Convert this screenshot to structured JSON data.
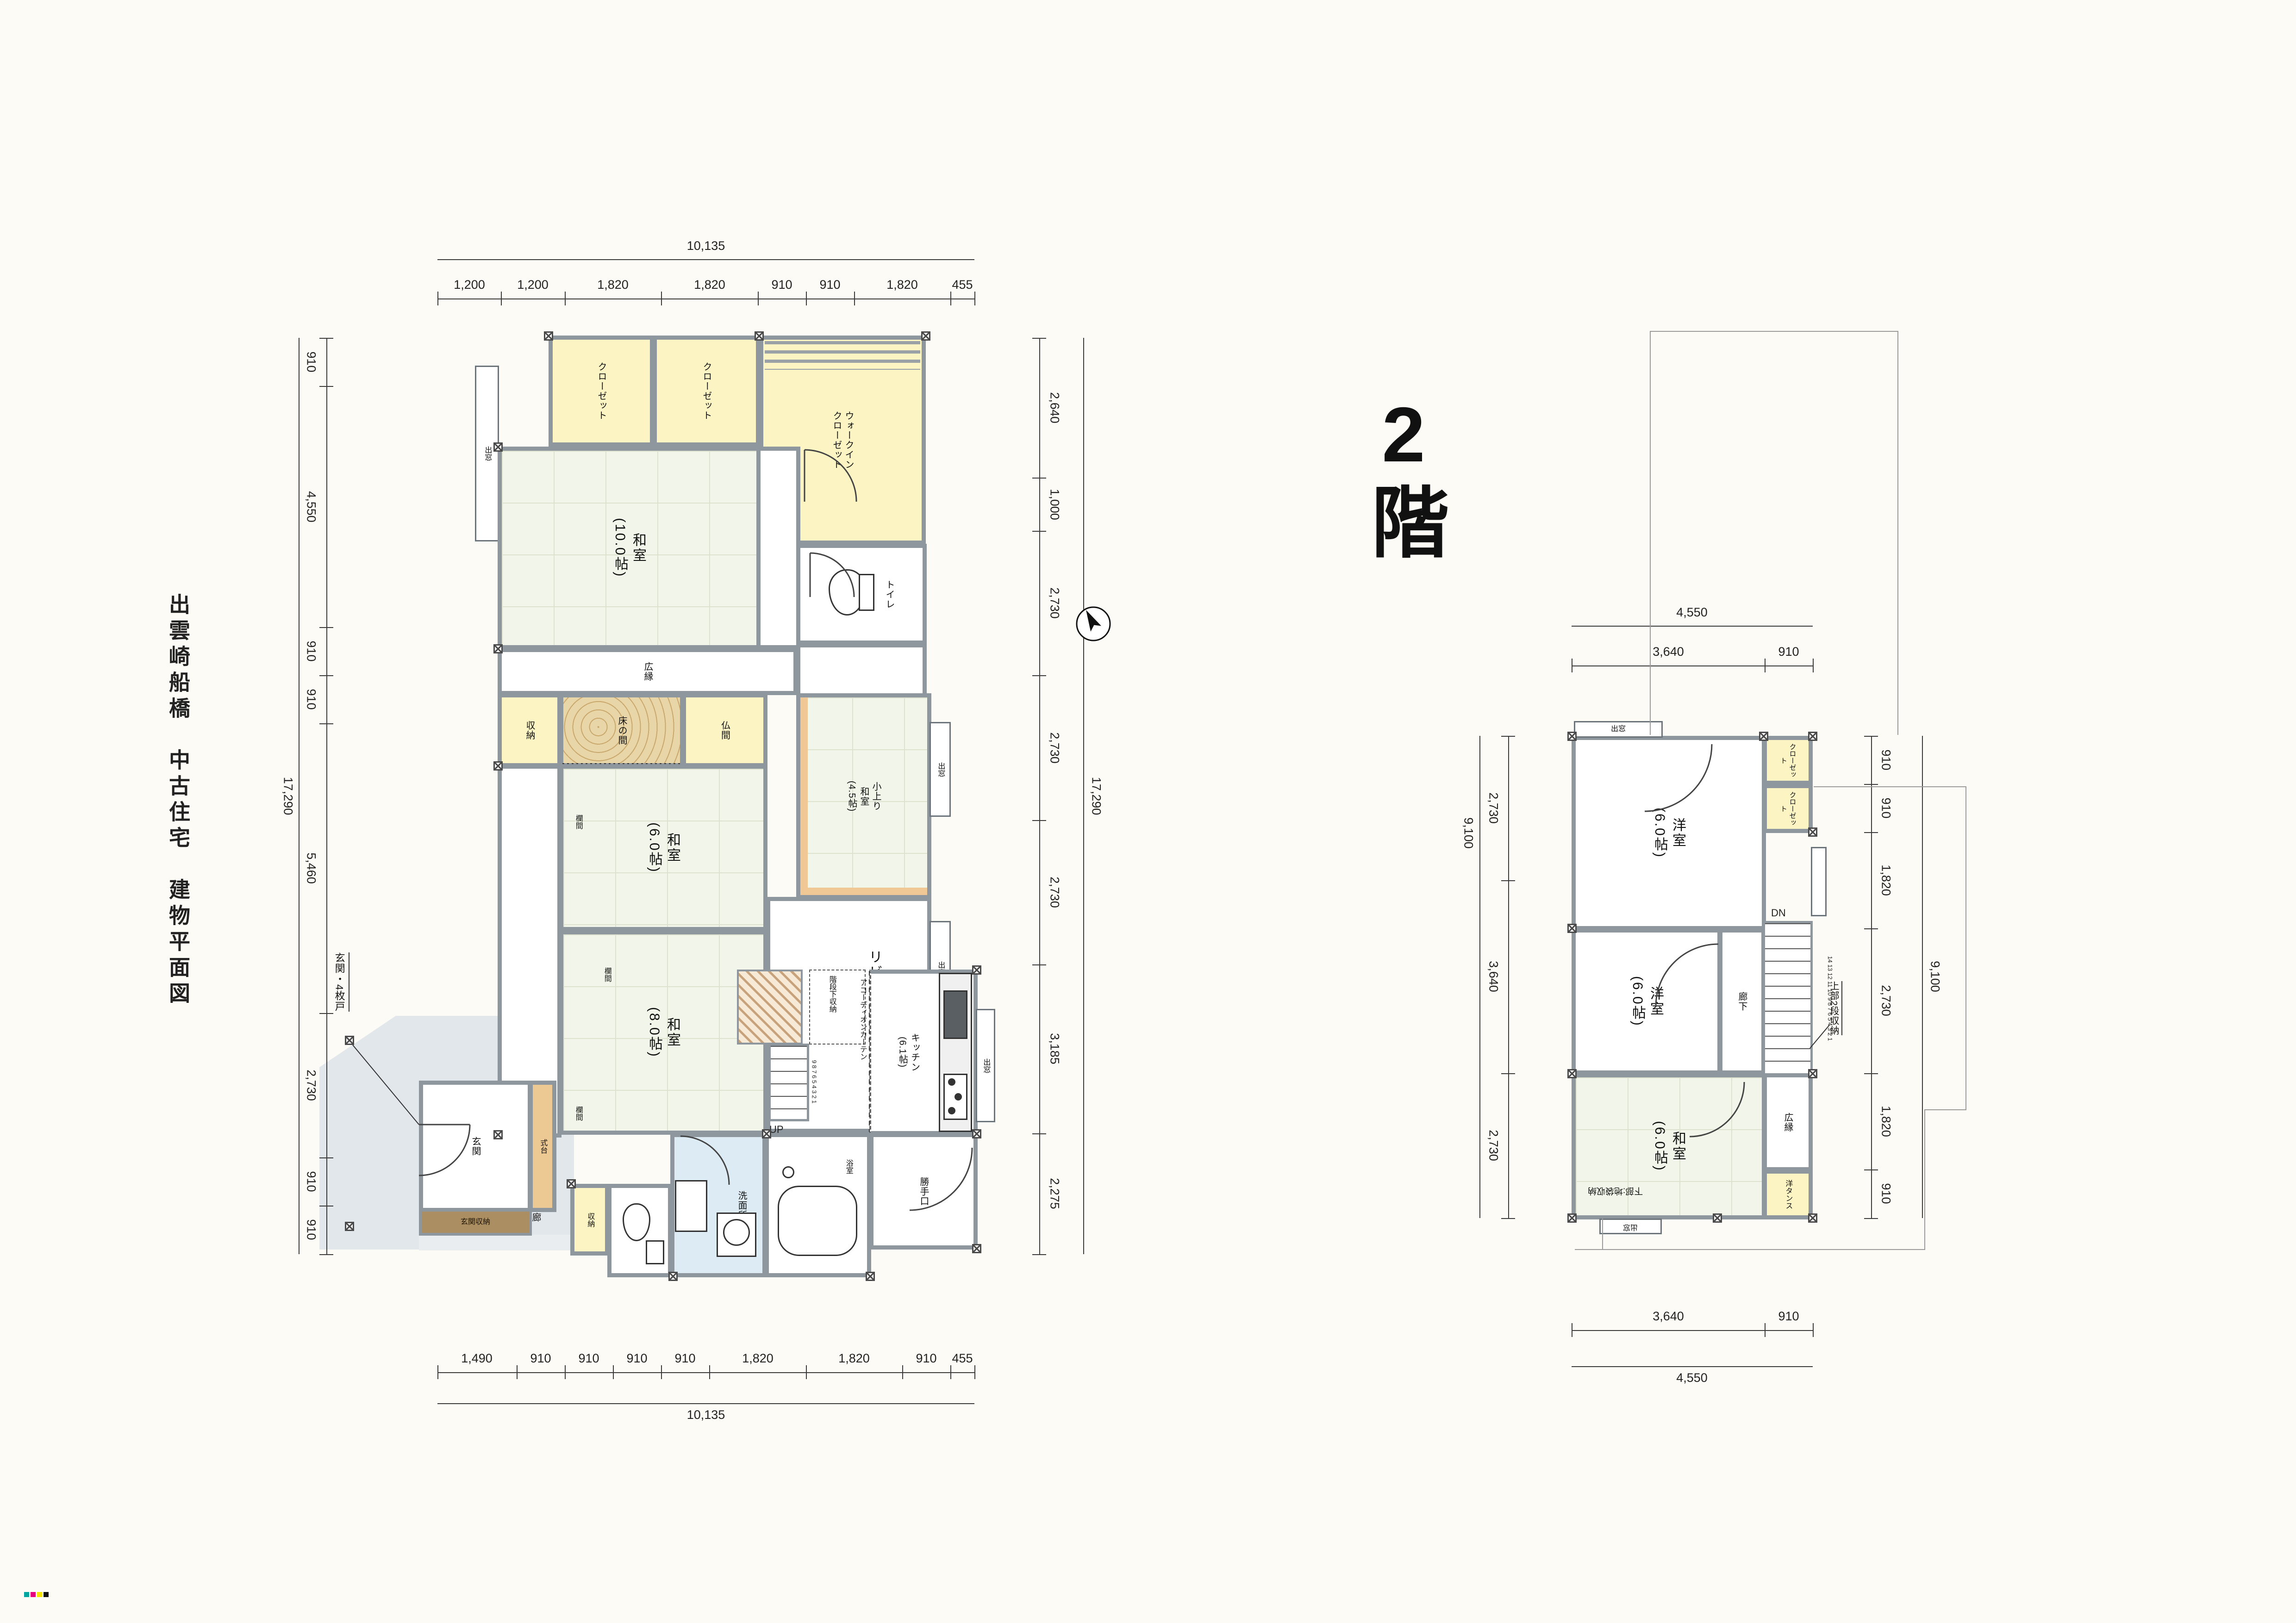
{
  "page": {
    "title": "出雲崎船橋　中古住宅　建物平面図"
  },
  "colors": {
    "wall": "#8e979e",
    "tatami": "#f2f5e9",
    "closet_yellow": "#fcf4c2",
    "tokonoma_wood": "#e8d6a9",
    "shikidai_wood": "#ecc892",
    "cabinet_brown": "#ab8f62",
    "wet_blue": "#ddecf4",
    "porch_gray": "#e2e7ec",
    "stair_hatch": "#c1946a"
  },
  "floor1": {
    "name": "1階",
    "dims": {
      "top_total": "10,135",
      "top_segments": [
        "1,200",
        "1,200",
        "1,820",
        "1,820",
        "910",
        "910",
        "1,820",
        "455"
      ],
      "bottom_segments": [
        "1,490",
        "910",
        "910",
        "910",
        "910",
        "1,820",
        "1,820",
        "910",
        "455"
      ],
      "bottom_total": "10,135",
      "left_segments": [
        "910",
        "4,550",
        "910",
        "910",
        "5,460",
        "2,730",
        "910",
        "910"
      ],
      "left_total": "17,290",
      "right_segments": [
        "2,640",
        "1,000",
        "2,730",
        "2,730",
        "2,730",
        "3,185",
        "2,275"
      ],
      "right_total": "17,290"
    },
    "rooms": {
      "closet": "クローゼット",
      "wic": "ウォークイン\nクローゼット",
      "demado": "出窓",
      "washitsu10": "和室\n(10.0帖)",
      "toilet": "トイレ",
      "kitchen3": "キッチン\n(3.0帖)",
      "hiroen": "広縁",
      "shuno": "収納",
      "tokonoma": "床の間",
      "butsuma": "仏間",
      "washitsu6": "和室\n(6.0帖)",
      "ranma": "欄間",
      "rouka": "廊下",
      "washitsu8": "和室\n(8.0帖)",
      "koagari": "小上り\n和室\n(4.5帖)",
      "living": "リビング",
      "niche": "ニッチ",
      "understair": "階段下収納",
      "stair_steps": "9 8 7 6 5 4 3 2 1",
      "up": "UP",
      "accordion": "アコーディオンカーテン",
      "kitchen61": "キッチン\n(6.1帖)",
      "katte": "勝手口",
      "bath": "浴室",
      "senmen": "洗面所",
      "genkan": "玄関",
      "shikidai": "式台",
      "genkan_storage": "玄関収納",
      "genkan_note": "玄関・4枚戸"
    }
  },
  "floor2": {
    "name": "2階",
    "dims": {
      "top_total": "4,550",
      "top_segments": [
        "3,640",
        "910"
      ],
      "bottom_segments": [
        "3,640",
        "910"
      ],
      "bottom_total": "4,550",
      "left_segments": [
        "2,730",
        "3,640",
        "2,730"
      ],
      "left_total": "9,100",
      "right_segments": [
        "910",
        "910",
        "1,820",
        "2,730",
        "1,820",
        "910"
      ],
      "right_total": "9,100"
    },
    "rooms": {
      "demado": "出窓",
      "yoshitsu": "洋室\n(6.0帖)",
      "closet": "クローゼット",
      "rouka": "廊下",
      "dn": "DN",
      "stair_steps": "14 13 12 11 10 9 8 7 6 5 4 3 2 1",
      "upper_storage": "上部2段収納",
      "hiroen": "広縁",
      "washitsu": "和室\n(6.0帖)",
      "yotansu": "洋タンス",
      "lower_storage": "下部:地袋収納"
    }
  }
}
